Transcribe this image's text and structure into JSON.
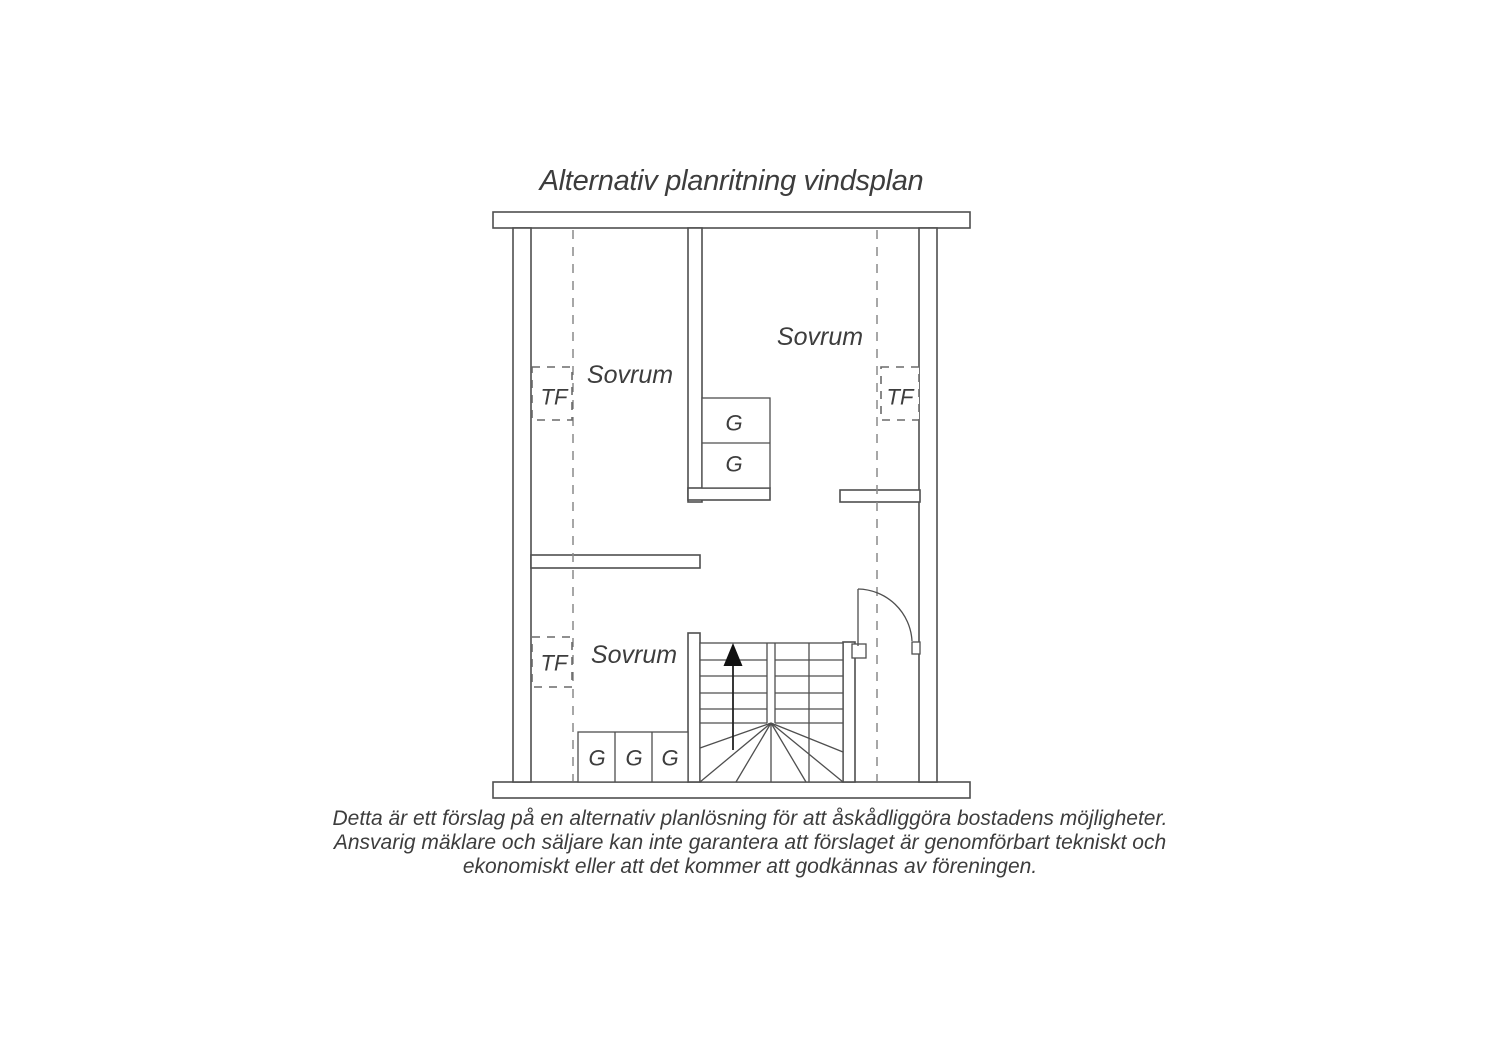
{
  "title": "Alternativ planritning vindsplan",
  "plan": {
    "rooms": [
      {
        "id": "sovrum-top-left",
        "label": "Sovrum"
      },
      {
        "id": "sovrum-top-right",
        "label": "Sovrum"
      },
      {
        "id": "sovrum-bottom-left",
        "label": "Sovrum"
      }
    ],
    "markers": {
      "tf_label": "TF",
      "wardrobe_label": "G"
    },
    "stair_direction": "up"
  },
  "disclaimer": {
    "lines": [
      "Detta är ett förslag på en alternativ planlösning för att åskådliggöra bostadens möjligheter.",
      "Ansvarig mäklare och säljare kan inte garantera att förslaget är genomförbart tekniskt och",
      "ekonomiskt eller att det kommer att godkännas av föreningen."
    ]
  },
  "colors": {
    "wall_line": "#4f4f4f",
    "dashed_line": "#8a8a8a",
    "text": "#3d3d3d",
    "arrow": "#111111",
    "background": "#ffffff"
  }
}
